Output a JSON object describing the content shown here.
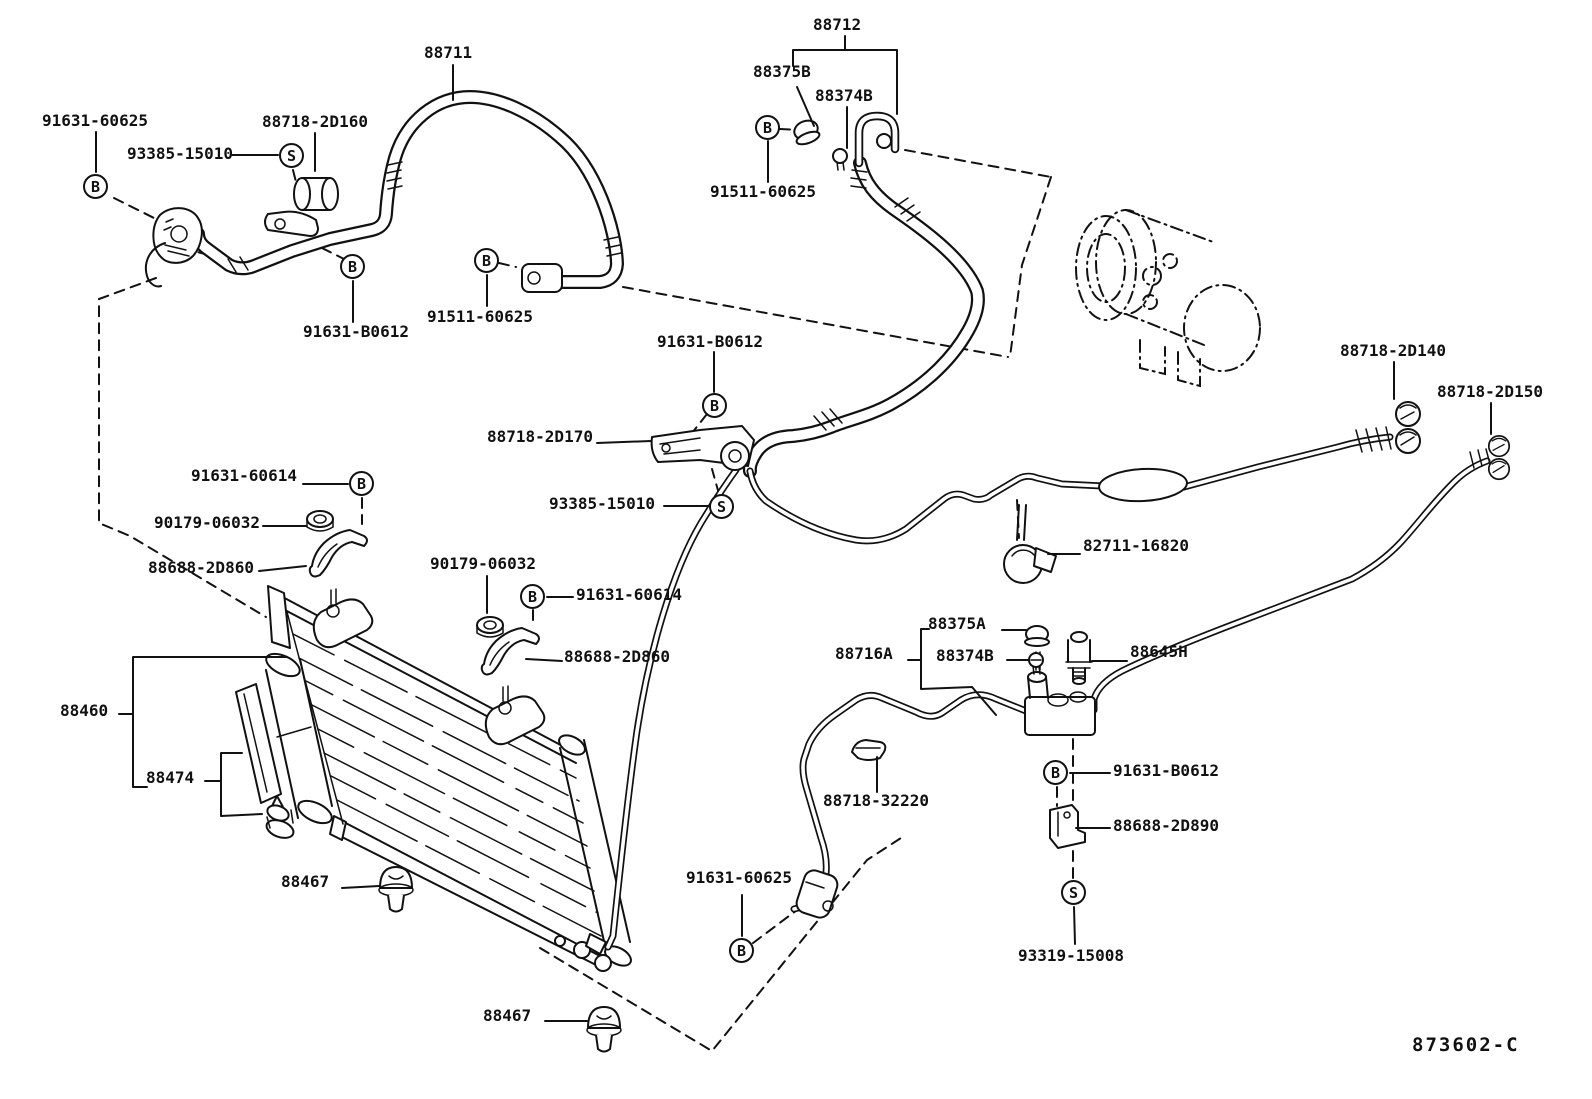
{
  "drawing": {
    "number": "873602-C",
    "background_color": "#ffffff",
    "line_color": "#111111",
    "marker_legend": {
      "B": "bolt",
      "S": "screw"
    }
  },
  "labels": [
    {
      "text": "88711"
    },
    {
      "text": "88712"
    },
    {
      "text": "88375B"
    },
    {
      "text": "88374B"
    },
    {
      "text": "91511-60625"
    },
    {
      "text": "91631-60625"
    },
    {
      "text": "93385-15010"
    },
    {
      "text": "88718-2D160"
    },
    {
      "text": "91631-B0612"
    },
    {
      "text": "91511-60625"
    },
    {
      "text": "91631-B0612"
    },
    {
      "text": "88718-2D170"
    },
    {
      "text": "93385-15010"
    },
    {
      "text": "91631-60614"
    },
    {
      "text": "90179-06032"
    },
    {
      "text": "88688-2D860"
    },
    {
      "text": "90179-06032"
    },
    {
      "text": "91631-60614"
    },
    {
      "text": "88688-2D860"
    },
    {
      "text": "88460"
    },
    {
      "text": "88474"
    },
    {
      "text": "88467"
    },
    {
      "text": "88467"
    },
    {
      "text": "91631-60625"
    },
    {
      "text": "88718-32220"
    },
    {
      "text": "88375A"
    },
    {
      "text": "88716A"
    },
    {
      "text": "88374B"
    },
    {
      "text": "88645H"
    },
    {
      "text": "82711-16820"
    },
    {
      "text": "88718-2D140"
    },
    {
      "text": "88718-2D150"
    },
    {
      "text": "91631-B0612"
    },
    {
      "text": "88688-2D890"
    },
    {
      "text": "93319-15008"
    },
    {
      "text": "873602-C"
    }
  ],
  "markers": [
    {
      "letter": "B"
    },
    {
      "letter": "S"
    },
    {
      "letter": "B"
    },
    {
      "letter": "B"
    },
    {
      "letter": "B"
    },
    {
      "letter": "B"
    },
    {
      "letter": "S"
    },
    {
      "letter": "B"
    },
    {
      "letter": "B"
    },
    {
      "letter": "B"
    },
    {
      "letter": "B"
    },
    {
      "letter": "S"
    }
  ]
}
